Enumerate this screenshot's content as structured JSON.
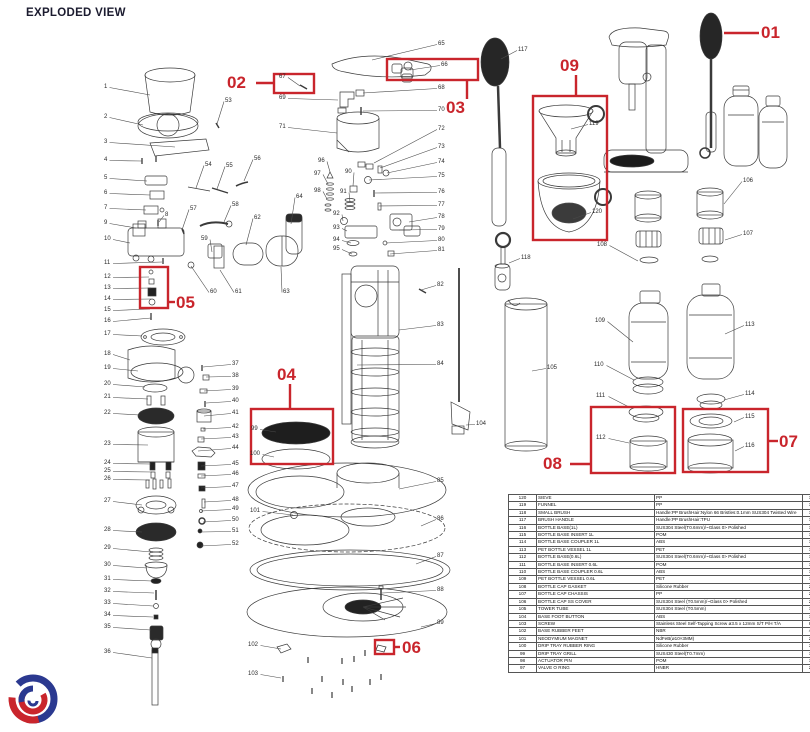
{
  "title": "EXPLODED VIEW",
  "colors": {
    "accent_red": "#c9252c",
    "leader_line": "#4a4a4a",
    "logo_blue": "#2b3990",
    "logo_red": "#c9252c"
  },
  "callouts": [
    {
      "label": "01",
      "text_x": 761,
      "text_y": 24,
      "line": [
        724,
        33,
        759,
        33
      ],
      "box": null
    },
    {
      "label": "02",
      "text_x": 227,
      "text_y": 74,
      "line": [
        256,
        83,
        273,
        83
      ],
      "box": [
        274,
        74,
        40,
        19
      ]
    },
    {
      "label": "03",
      "text_x": 446,
      "text_y": 99,
      "line": [
        467,
        80,
        467,
        99
      ],
      "box": [
        387,
        59,
        91,
        21
      ]
    },
    {
      "label": "04",
      "text_x": 277,
      "text_y": 366,
      "line": [
        290,
        384,
        290,
        409
      ],
      "box": [
        251,
        409,
        82,
        55
      ]
    },
    {
      "label": "05",
      "text_x": 176,
      "text_y": 294,
      "line": [
        168,
        302,
        175,
        302
      ],
      "box": [
        140,
        267,
        28,
        41
      ]
    },
    {
      "label": "06",
      "text_x": 402,
      "text_y": 639,
      "line": [
        394,
        647,
        400,
        647
      ],
      "box": [
        375,
        640,
        19,
        14
      ]
    },
    {
      "label": "07",
      "text_x": 779,
      "text_y": 433,
      "line": [
        769,
        441,
        778,
        441
      ],
      "box": [
        683,
        409,
        85,
        63
      ]
    },
    {
      "label": "08",
      "text_x": 543,
      "text_y": 455,
      "line": [
        570,
        464,
        591,
        464
      ],
      "box": [
        591,
        407,
        84,
        66
      ]
    },
    {
      "label": "09",
      "text_x": 560,
      "text_y": 57,
      "line": [
        576,
        75,
        576,
        96
      ],
      "box": [
        533,
        96,
        74,
        144
      ]
    }
  ],
  "part_labels": [
    [
      1,
      104,
      84,
      150,
      95
    ],
    [
      2,
      104,
      114,
      143,
      125
    ],
    [
      3,
      104,
      139,
      175,
      147
    ],
    [
      4,
      104,
      157,
      142,
      161
    ],
    [
      5,
      104,
      175,
      147,
      181
    ],
    [
      6,
      104,
      190,
      150,
      195
    ],
    [
      7,
      104,
      205,
      146,
      210
    ],
    [
      8,
      165,
      212,
      159,
      222
    ],
    [
      9,
      104,
      220,
      136,
      228
    ],
    [
      10,
      104,
      236,
      130,
      243
    ],
    [
      11,
      104,
      260,
      162,
      262
    ],
    [
      12,
      104,
      274,
      149,
      277
    ],
    [
      13,
      104,
      285,
      151,
      288
    ],
    [
      14,
      104,
      296,
      151,
      299
    ],
    [
      15,
      104,
      307,
      150,
      309
    ],
    [
      16,
      104,
      318,
      151,
      318
    ],
    [
      17,
      104,
      331,
      142,
      336
    ],
    [
      18,
      104,
      351,
      130,
      360
    ],
    [
      19,
      104,
      365,
      138,
      371
    ],
    [
      20,
      104,
      381,
      145,
      387
    ],
    [
      21,
      104,
      394,
      148,
      399
    ],
    [
      22,
      104,
      410,
      140,
      415
    ],
    [
      23,
      104,
      441,
      148,
      445
    ],
    [
      24,
      104,
      460,
      151,
      464
    ],
    [
      25,
      104,
      468,
      152,
      472
    ],
    [
      26,
      104,
      476,
      150,
      480
    ],
    [
      27,
      104,
      498,
      142,
      505
    ],
    [
      28,
      104,
      527,
      142,
      532
    ],
    [
      29,
      104,
      545,
      151,
      552
    ],
    [
      30,
      104,
      562,
      147,
      568
    ],
    [
      31,
      104,
      576,
      152,
      581
    ],
    [
      32,
      104,
      588,
      154,
      593
    ],
    [
      33,
      104,
      600,
      153,
      606
    ],
    [
      34,
      104,
      612,
      153,
      617
    ],
    [
      35,
      104,
      624,
      151,
      630
    ],
    [
      36,
      104,
      649,
      152,
      658
    ],
    [
      37,
      232,
      361,
      203,
      367
    ],
    [
      38,
      232,
      373,
      206,
      377
    ],
    [
      39,
      232,
      386,
      204,
      391
    ],
    [
      40,
      232,
      398,
      206,
      403
    ],
    [
      41,
      232,
      410,
      204,
      416
    ],
    [
      42,
      232,
      424,
      203,
      429
    ],
    [
      43,
      232,
      434,
      201,
      439
    ],
    [
      44,
      232,
      445,
      198,
      451
    ],
    [
      45,
      232,
      461,
      201,
      466
    ],
    [
      46,
      232,
      471,
      201,
      476
    ],
    [
      47,
      232,
      483,
      201,
      488
    ],
    [
      48,
      232,
      497,
      204,
      502
    ],
    [
      49,
      232,
      506,
      201,
      511
    ],
    [
      50,
      232,
      517,
      203,
      522
    ],
    [
      51,
      232,
      528,
      201,
      532
    ],
    [
      52,
      232,
      541,
      201,
      546
    ],
    [
      53,
      225,
      98,
      217,
      124
    ],
    [
      54,
      205,
      162,
      196,
      188
    ],
    [
      55,
      226,
      163,
      217,
      189
    ],
    [
      56,
      254,
      156,
      244,
      181
    ],
    [
      57,
      190,
      206,
      182,
      230
    ],
    [
      58,
      232,
      202,
      224,
      222
    ],
    [
      59,
      201,
      236,
      212,
      252
    ],
    [
      60,
      210,
      289,
      191,
      266
    ],
    [
      61,
      235,
      289,
      220,
      270
    ],
    [
      62,
      254,
      215,
      246,
      245
    ],
    [
      63,
      283,
      289,
      281,
      267
    ],
    [
      64,
      296,
      194,
      291,
      224
    ],
    [
      65,
      438,
      41,
      372,
      60
    ],
    [
      66,
      441,
      62,
      410,
      70
    ],
    [
      67,
      279,
      74,
      300,
      86
    ],
    [
      68,
      438,
      85,
      363,
      93
    ],
    [
      69,
      279,
      95,
      338,
      100
    ],
    [
      70,
      438,
      107,
      363,
      111
    ],
    [
      71,
      279,
      124,
      337,
      133
    ],
    [
      72,
      438,
      126,
      374,
      163
    ],
    [
      73,
      438,
      144,
      380,
      168
    ],
    [
      74,
      438,
      159,
      387,
      173
    ],
    [
      75,
      438,
      173,
      369,
      180
    ],
    [
      76,
      438,
      189,
      375,
      193
    ],
    [
      77,
      438,
      202,
      379,
      206
    ],
    [
      78,
      438,
      214,
      409,
      222
    ],
    [
      79,
      438,
      226,
      399,
      230
    ],
    [
      80,
      438,
      237,
      386,
      243
    ],
    [
      81,
      438,
      247,
      390,
      254
    ],
    [
      82,
      437,
      282,
      421,
      290
    ],
    [
      83,
      437,
      322,
      399,
      330
    ],
    [
      84,
      437,
      361,
      357,
      365
    ],
    [
      85,
      437,
      478,
      399,
      489
    ],
    [
      86,
      437,
      516,
      421,
      526
    ],
    [
      87,
      437,
      553,
      416,
      564
    ],
    [
      88,
      437,
      587,
      382,
      593
    ],
    [
      89,
      437,
      620,
      421,
      627
    ],
    [
      90,
      345,
      169,
      353,
      186
    ],
    [
      91,
      340,
      189,
      350,
      202
    ],
    [
      92,
      333,
      211,
      343,
      221
    ],
    [
      93,
      333,
      225,
      347,
      231
    ],
    [
      94,
      333,
      237,
      351,
      243
    ],
    [
      95,
      333,
      246,
      352,
      254
    ],
    [
      96,
      318,
      158,
      330,
      172
    ],
    [
      97,
      314,
      171,
      328,
      184
    ],
    [
      98,
      314,
      188,
      327,
      199
    ],
    [
      99,
      251,
      426,
      276,
      432
    ],
    [
      100,
      250,
      451,
      274,
      457
    ],
    [
      101,
      250,
      508,
      293,
      515
    ],
    [
      102,
      248,
      642,
      281,
      649
    ],
    [
      103,
      248,
      671,
      281,
      678
    ],
    [
      104,
      476,
      421,
      466,
      425
    ],
    [
      105,
      547,
      365,
      532,
      371
    ],
    [
      106,
      743,
      178,
      724,
      204
    ],
    [
      107,
      743,
      231,
      725,
      240
    ],
    [
      108,
      597,
      242,
      638,
      261
    ],
    [
      109,
      595,
      318,
      633,
      342
    ],
    [
      110,
      594,
      362,
      634,
      380
    ],
    [
      111,
      596,
      393,
      629,
      407
    ],
    [
      112,
      596,
      435,
      629,
      443
    ],
    [
      113,
      745,
      322,
      725,
      334
    ],
    [
      114,
      745,
      391,
      724,
      400
    ],
    [
      115,
      745,
      414,
      734,
      422
    ],
    [
      116,
      745,
      443,
      735,
      451
    ],
    [
      117,
      518,
      47,
      501,
      59
    ],
    [
      118,
      521,
      255,
      509,
      263
    ],
    [
      119,
      589,
      121,
      571,
      129
    ],
    [
      120,
      592,
      209,
      573,
      219
    ]
  ],
  "table": {
    "columns": [
      "no",
      "description",
      "material",
      "qty"
    ],
    "rows": [
      [
        "120",
        "SIEVE",
        "PP",
        "1"
      ],
      [
        "119",
        "FUNNEL",
        "PP",
        "1"
      ],
      [
        "118",
        "SMALL BRUSH",
        "Handle:PP  BrushHair:Nylon 66  Bristles:0.1mm SUS304 Twisted Wire",
        "1"
      ],
      [
        "117",
        "BRUSH HANDLE",
        "Handle:PP  BrushHair:TPU",
        "1"
      ],
      [
        "116",
        "BOTTLE BASE(1L)",
        "SUS304 Steel(T0.6mm)/~Glass 0> Polished",
        "1"
      ],
      [
        "115",
        "BOTTLE BASE INSERT 1L",
        "POM",
        "1"
      ],
      [
        "114",
        "BOTTLE BASE COUPLER 1L",
        "ABS",
        "1"
      ],
      [
        "113",
        "PET BOTTLE VESSEL 1L",
        "PET",
        "1"
      ],
      [
        "112",
        "BOTTLE BASE(0.6L)",
        "SUS304 Steel(T0.6mm)/~Glass 0> Polished",
        "1"
      ],
      [
        "111",
        "BOTTLE BASE INSERT 0.6L",
        "POM",
        "1"
      ],
      [
        "110",
        "BOTTLE BASE COUPLER 0.6L",
        "ABS",
        "1"
      ],
      [
        "109",
        "PET BOTTLE VESSEL 0.6L",
        "PET",
        "1"
      ],
      [
        "108",
        "BOTTLE CAP GASKET",
        "Silicone Rubber",
        "2"
      ],
      [
        "107",
        "BOTTLE CAP CHASSIS",
        "PP",
        "2"
      ],
      [
        "106",
        "BOTTLE CAP SS COVER",
        "SUS304 Steel (T0.5mm)/~Glass 0> Polished",
        "2"
      ],
      [
        "105",
        "TOWER TUBE",
        "SUS304 Steel (T0.5mm)",
        "1"
      ],
      [
        "104",
        "BASE FOOT BUTTON",
        "ABS",
        "1"
      ],
      [
        "103",
        "SCREW",
        "Stainless Steel Self-Tapping Screw ø3.5 x 12mm S/T P/H T/A",
        "8"
      ],
      [
        "102",
        "BASE RUBBER FEET",
        "NBR",
        "4"
      ],
      [
        "101",
        "NEODYMIUM MAGNET",
        "NdFeB(ø10×3MM)",
        "2"
      ],
      [
        "100",
        "DRIP TRAY RUBBER RING",
        "Silicone Rubber",
        "3"
      ],
      [
        "99",
        "DRIP TRAY GRILL",
        "SUS430 Steel(T0.7mm)",
        "1"
      ],
      [
        "98",
        "ACTUATOR PIN",
        "POM",
        "1"
      ],
      [
        "97",
        "VALVE O RING",
        "HNBR",
        "2"
      ]
    ]
  }
}
